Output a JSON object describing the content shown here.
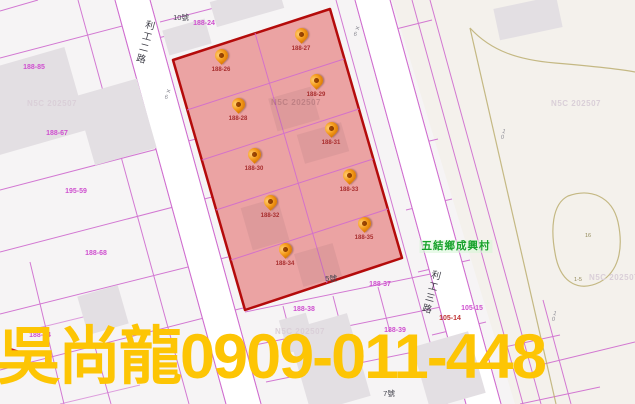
{
  "overlay": {
    "agent_name": "吳尚龍",
    "phone": "0909-011-448"
  },
  "map": {
    "watermark": "N5C 202507",
    "village_label": "五結鄉成興村",
    "road_labels": [
      {
        "text": "利工二路"
      },
      {
        "text": "利工三路"
      }
    ],
    "road_marks": [
      {
        "text": "✕6"
      },
      {
        "text": "✕6"
      },
      {
        "text": "10"
      },
      {
        "text": "10"
      }
    ],
    "pond_labels": [
      {
        "text": "16"
      },
      {
        "text": "1-5"
      }
    ],
    "pins": [
      {
        "label": "188-26"
      },
      {
        "label": "188-27"
      },
      {
        "label": "188-28"
      },
      {
        "label": "188-29"
      },
      {
        "label": "188-30"
      },
      {
        "label": "188-31"
      },
      {
        "label": "188-32"
      },
      {
        "label": "188-33"
      },
      {
        "label": "188-34"
      },
      {
        "label": "188-35"
      }
    ],
    "parcel_labels": [
      {
        "text": "188-24"
      },
      {
        "text": "188-85"
      },
      {
        "text": "188-67"
      },
      {
        "text": "195-59"
      },
      {
        "text": "188-68"
      },
      {
        "text": "188-84"
      },
      {
        "text": "188-37"
      },
      {
        "text": "188-38"
      },
      {
        "text": "188-39"
      },
      {
        "text": "105-15"
      },
      {
        "text": "105-14"
      }
    ],
    "house_labels": [
      {
        "text": "10號"
      },
      {
        "text": "5號"
      },
      {
        "text": "7號"
      }
    ]
  },
  "colors": {
    "selection_fill": "#f0a9a9",
    "selection_border": "#b40b0b",
    "parcel_line": "#cf6bcf",
    "pin_orange": "#f59d1d",
    "highlight_yellow": "#fdc504",
    "village_green": "#18a22c"
  }
}
